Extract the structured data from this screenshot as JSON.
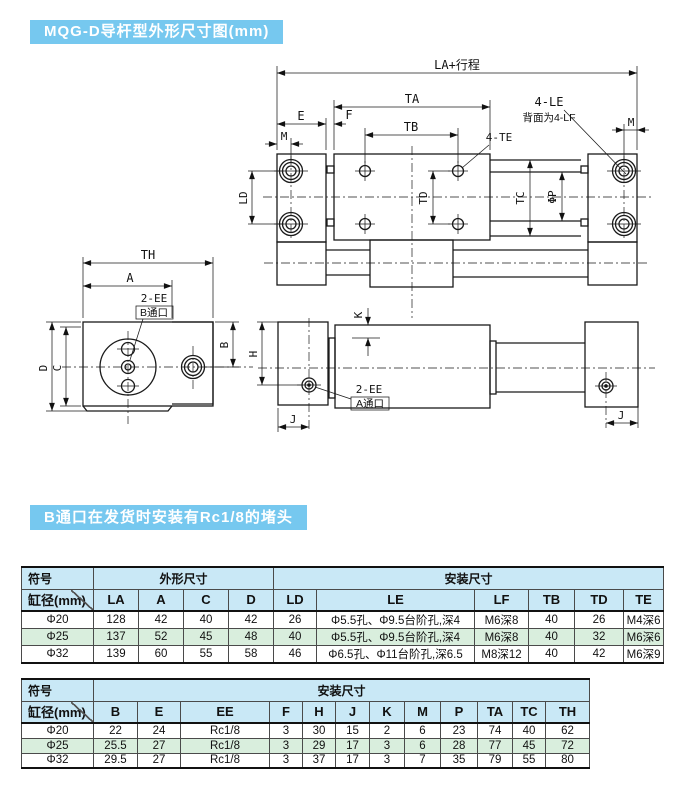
{
  "page": {
    "title_banner": "MQG-D导杆型外形尺寸图(mm)",
    "note_banner": "B通口在发货时安装有Rc1/8的堵头"
  },
  "colors": {
    "banner_blue": "#76c8ef",
    "header_blue": "#c9e8f6",
    "row_green": "#d9eedd",
    "row_white": "#ffffff",
    "grid": "#4a4a4a",
    "ink": "#111111"
  },
  "drawing": {
    "la": "LA+行程",
    "ta": "TA",
    "tb": "TB",
    "e": "E",
    "f": "F",
    "m": "M",
    "four_le": "4-LE",
    "four_lf_note": "背面为4-LF",
    "four_te": "4-TE",
    "ld": "LD",
    "td": "TD",
    "tc": "TC",
    "phi_p": "ΦP",
    "th": "TH",
    "a": "A",
    "two_ee": "2-EE",
    "port_b": "B通口",
    "port_a": "A通口",
    "d": "D",
    "c": "C",
    "b": "B",
    "h": "H",
    "k": "K",
    "j": "J"
  },
  "table1": {
    "symbol_label": "符号",
    "bore_label": "缸径(mm)",
    "outline_label": "外形尺寸",
    "mount_label": "安装尺寸",
    "columns": [
      "LA",
      "A",
      "C",
      "D",
      "LD",
      "LE",
      "LF",
      "TB",
      "TD",
      "TE"
    ],
    "rows": [
      [
        "Φ20",
        "128",
        "42",
        "40",
        "42",
        "26",
        "Φ5.5孔、Φ9.5台阶孔,深4",
        "M6深8",
        "40",
        "26",
        "M4深6"
      ],
      [
        "Φ25",
        "137",
        "52",
        "45",
        "48",
        "40",
        "Φ5.5孔、Φ9.5台阶孔,深4",
        "M6深8",
        "40",
        "32",
        "M6深6"
      ],
      [
        "Φ32",
        "139",
        "60",
        "55",
        "58",
        "46",
        "Φ6.5孔、Φ11台阶孔,深6.5",
        "M8深12",
        "40",
        "42",
        "M6深9"
      ]
    ]
  },
  "table2": {
    "symbol_label": "符号",
    "bore_label": "缸径(mm)",
    "mount_label": "安装尺寸",
    "columns": [
      "B",
      "E",
      "EE",
      "F",
      "H",
      "J",
      "K",
      "M",
      "P",
      "TA",
      "TC",
      "TH"
    ],
    "rows": [
      [
        "Φ20",
        "22",
        "24",
        "Rc1/8",
        "3",
        "30",
        "15",
        "2",
        "6",
        "23",
        "74",
        "40",
        "62"
      ],
      [
        "Φ25",
        "25.5",
        "27",
        "Rc1/8",
        "3",
        "29",
        "17",
        "3",
        "6",
        "28",
        "77",
        "45",
        "72"
      ],
      [
        "Φ32",
        "29.5",
        "27",
        "Rc1/8",
        "3",
        "37",
        "17",
        "3",
        "7",
        "35",
        "79",
        "55",
        "80"
      ]
    ]
  }
}
